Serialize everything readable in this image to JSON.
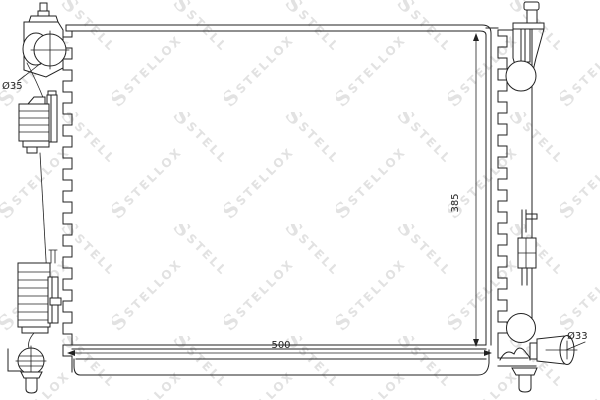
{
  "drawing": {
    "part_type": "radiator-technical-drawing",
    "labels": {
      "inlet_diameter": "Ø35",
      "core_height": "385",
      "core_width": "500",
      "outlet_diameter": "Ø33"
    },
    "watermark": {
      "logo": "S",
      "text": "STELLOX",
      "color": "#e2e2e2"
    },
    "colors": {
      "line": "#222222",
      "background": "#ffffff"
    }
  }
}
